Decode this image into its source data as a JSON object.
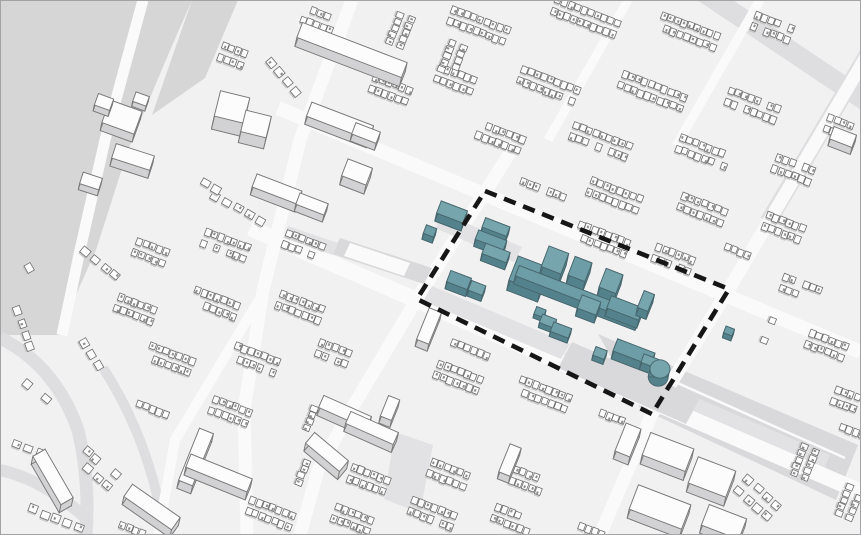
{
  "scene": {
    "width": 861,
    "height": 535,
    "description": "axonometric-3d-city-massing-map-with-highlighted-site",
    "colors": {
      "ground": "#f1f1f2",
      "park": "#d6d6d7",
      "paved": "#d9d9db",
      "paved_light": "#e2e2e4",
      "road_white": "#fafafb",
      "road_gray": "#dedee0",
      "house_top": "#fdfdfd",
      "house_side": "#c9c9c9",
      "house_stroke": "#6e6e6e",
      "house_mark": "#8f8f8f",
      "slab_top": "#fcfcfd",
      "slab_side": "#d2d2d4",
      "slab_stroke": "#7a7a7a",
      "teal_top": "#76a5ad",
      "teal_top_alt": "#6d9da6",
      "teal_side": "#54828c",
      "teal_stroke": "#47666d",
      "boundary": "#161616",
      "frame": "#a3a3a6"
    }
  },
  "areas": [
    {
      "pts": [
        [
          0,
          0
        ],
        [
          192,
          0
        ],
        [
          168,
          55
        ],
        [
          128,
          150
        ],
        [
          96,
          250
        ],
        [
          58,
          335
        ],
        [
          0,
          335
        ]
      ],
      "fill": "park",
      "over": false
    },
    {
      "pts": [
        [
          192,
          0
        ],
        [
          238,
          0
        ],
        [
          205,
          78
        ],
        [
          152,
          115
        ]
      ],
      "fill": "park",
      "over": false
    },
    {
      "pts": [
        [
          598,
          334
        ],
        [
          858,
          445
        ],
        [
          836,
          500
        ],
        [
          640,
          408
        ]
      ],
      "fill": "paved",
      "over": false
    },
    {
      "pts": [
        [
          690,
          395
        ],
        [
          830,
          455
        ],
        [
          818,
          482
        ],
        [
          676,
          420
        ]
      ],
      "fill": "paved_light",
      "over": false
    },
    {
      "pts": [
        [
          432,
          286
        ],
        [
          570,
          344
        ],
        [
          561,
          359
        ],
        [
          423,
          301
        ]
      ],
      "fill": "paved_light",
      "over": true
    },
    {
      "pts": [
        [
          572,
          342
        ],
        [
          700,
          398
        ],
        [
          686,
          424
        ],
        [
          558,
          368
        ]
      ],
      "fill": "paved",
      "over": true
    },
    {
      "pts": [
        [
          443,
          213
        ],
        [
          522,
          247
        ],
        [
          514,
          262
        ],
        [
          435,
          228
        ]
      ],
      "fill": "paved_light",
      "over": true
    },
    {
      "pts": [
        [
          340,
          238
        ],
        [
          432,
          268
        ],
        [
          424,
          284
        ],
        [
          332,
          254
        ]
      ],
      "fill": "paved",
      "over": true
    },
    {
      "pts": [
        [
          350,
          243
        ],
        [
          410,
          263
        ],
        [
          404,
          276
        ],
        [
          344,
          256
        ]
      ],
      "fill": "road_white",
      "over": true
    },
    {
      "pts": [
        [
          288,
          226
        ],
        [
          338,
          243
        ],
        [
          333,
          255
        ],
        [
          283,
          238
        ]
      ],
      "fill": "paved_light",
      "over": true
    },
    {
      "pts": [
        [
          395,
          432
        ],
        [
          433,
          445
        ],
        [
          420,
          513
        ],
        [
          384,
          499
        ]
      ],
      "fill": "paved_light",
      "over": true
    }
  ],
  "roads": [
    {
      "pts": [
        [
          700,
          -10
        ],
        [
          882,
          112
        ]
      ],
      "w": 20,
      "c": "road_gray"
    },
    {
      "pts": [
        [
          876,
          40
        ],
        [
          768,
          222
        ]
      ],
      "w": 17,
      "c": "road_gray"
    },
    {
      "path": "M103,368 Q150,440 165,535",
      "w": 10,
      "c": "road_gray"
    },
    {
      "path": "M0,338 Q55,365 78,430 Q90,480 86,535",
      "w": 13,
      "c": "road_gray"
    },
    {
      "path": "M0,470 Q45,480 88,520",
      "w": 12,
      "c": "road_gray"
    },
    {
      "pts": [
        [
          278,
          108
        ],
        [
          861,
          352
        ]
      ],
      "w": 14,
      "c": "road_white"
    },
    {
      "pts": [
        [
          250,
          228
        ],
        [
          861,
          492
        ]
      ],
      "w": 16,
      "c": "road_white"
    },
    {
      "pts": [
        [
          515,
          145
        ],
        [
          485,
          192
        ],
        [
          417,
          299
        ],
        [
          352,
          408
        ],
        [
          318,
          470
        ],
        [
          300,
          535
        ]
      ],
      "w": 13,
      "c": "road_white"
    },
    {
      "pts": [
        [
          876,
          40
        ],
        [
          729,
          289
        ],
        [
          652,
          414
        ],
        [
          600,
          535
        ]
      ],
      "w": 13,
      "c": "road_white"
    },
    {
      "pts": [
        [
          352,
          0
        ],
        [
          300,
          140
        ],
        [
          263,
          290
        ],
        [
          244,
          410
        ],
        [
          247,
          535
        ]
      ],
      "w": 13,
      "c": "road_white"
    },
    {
      "pts": [
        [
          143,
          0
        ],
        [
          105,
          140
        ],
        [
          80,
          250
        ],
        [
          62,
          335
        ]
      ],
      "w": 11,
      "c": "road_white"
    },
    {
      "pts": [
        [
          628,
          0
        ],
        [
          548,
          140
        ]
      ],
      "w": 9,
      "c": "road_white"
    },
    {
      "pts": [
        [
          760,
          0
        ],
        [
          676,
          146
        ]
      ],
      "w": 9,
      "c": "road_white"
    },
    {
      "pts": [
        [
          262,
          295
        ],
        [
          175,
          440
        ],
        [
          158,
          535
        ]
      ],
      "w": 10,
      "c": "road_white"
    },
    {
      "pts": [
        [
          615,
          355
        ],
        [
          845,
          458
        ]
      ],
      "w": 2.5,
      "c": "road_white"
    }
  ],
  "clusters": [
    [
      478,
      28,
      21,
      2,
      9,
      0
    ],
    [
      585,
      20,
      21,
      2,
      10,
      0
    ],
    [
      688,
      34,
      21,
      2,
      9,
      0
    ],
    [
      772,
      30,
      21,
      2,
      6,
      0
    ],
    [
      455,
      82,
      21,
      2,
      6,
      0
    ],
    [
      548,
      88,
      21,
      2,
      9,
      0
    ],
    [
      652,
      94,
      21,
      2,
      10,
      0
    ],
    [
      752,
      108,
      21,
      2,
      8,
      0
    ],
    [
      838,
      130,
      21,
      2,
      4,
      0
    ],
    [
      500,
      140,
      21,
      2,
      7,
      0
    ],
    [
      600,
      144,
      21,
      2,
      9,
      0
    ],
    [
      703,
      155,
      21,
      2,
      8,
      0
    ],
    [
      793,
      172,
      21,
      2,
      6,
      0
    ],
    [
      543,
      192,
      21,
      1,
      7,
      0
    ],
    [
      614,
      198,
      21,
      2,
      8,
      0
    ],
    [
      702,
      212,
      21,
      2,
      7,
      0
    ],
    [
      783,
      230,
      21,
      2,
      6,
      0
    ],
    [
      602,
      242,
      21,
      2,
      8,
      0
    ],
    [
      673,
      262,
      21,
      2,
      6,
      0
    ],
    [
      737,
      254,
      21,
      1,
      4,
      0
    ],
    [
      800,
      292,
      21,
      2,
      6,
      0
    ],
    [
      826,
      348,
      21,
      2,
      6,
      0
    ],
    [
      766,
      330,
      112,
      1,
      4,
      0
    ],
    [
      845,
      402,
      21,
      2,
      4,
      0
    ],
    [
      318,
      22,
      21,
      2,
      5,
      0
    ],
    [
      398,
      30,
      112,
      2,
      5,
      0
    ],
    [
      450,
      58,
      112,
      2,
      5,
      0
    ],
    [
      390,
      92,
      21,
      2,
      6,
      0
    ],
    [
      232,
      58,
      21,
      2,
      4,
      0
    ],
    [
      283,
      80,
      50,
      1,
      4,
      1
    ],
    [
      238,
      213,
      30,
      1,
      5,
      1
    ],
    [
      206,
      188,
      30,
      1,
      3,
      1
    ],
    [
      150,
      255,
      21,
      2,
      5,
      0
    ],
    [
      225,
      248,
      21,
      2,
      7,
      0
    ],
    [
      303,
      248,
      21,
      2,
      6,
      0
    ],
    [
      100,
      268,
      40,
      1,
      4,
      1
    ],
    [
      135,
      312,
      21,
      2,
      6,
      0
    ],
    [
      215,
      306,
      21,
      2,
      7,
      0
    ],
    [
      300,
      310,
      21,
      2,
      7,
      0
    ],
    [
      90,
      357,
      60,
      1,
      3,
      1
    ],
    [
      170,
      362,
      21,
      2,
      7,
      0
    ],
    [
      255,
      362,
      21,
      2,
      7,
      0
    ],
    [
      333,
      356,
      21,
      2,
      5,
      0
    ],
    [
      152,
      412,
      21,
      1,
      5,
      0
    ],
    [
      230,
      414,
      21,
      2,
      6,
      0
    ],
    [
      308,
      418,
      112,
      1,
      4,
      0
    ],
    [
      28,
      272,
      60,
      1,
      3,
      1
    ],
    [
      22,
      332,
      70,
      1,
      4,
      1
    ],
    [
      36,
      396,
      40,
      1,
      3,
      1
    ],
    [
      30,
      452,
      21,
      1,
      3,
      1
    ],
    [
      97,
      472,
      40,
      2,
      4,
      1
    ],
    [
      57,
      522,
      21,
      1,
      5,
      1
    ],
    [
      132,
      532,
      21,
      1,
      4,
      0
    ],
    [
      470,
      352,
      21,
      1,
      6,
      0
    ],
    [
      458,
      380,
      21,
      2,
      7,
      0
    ],
    [
      543,
      397,
      21,
      2,
      8,
      0
    ],
    [
      612,
      420,
      21,
      1,
      4,
      0
    ],
    [
      270,
      516,
      21,
      2,
      7,
      0
    ],
    [
      352,
      522,
      21,
      2,
      6,
      0
    ],
    [
      432,
      516,
      21,
      2,
      7,
      0
    ],
    [
      512,
      522,
      21,
      2,
      6,
      0
    ],
    [
      588,
      532,
      21,
      1,
      5,
      0
    ],
    [
      368,
      482,
      21,
      2,
      6,
      0
    ],
    [
      448,
      477,
      21,
      2,
      6,
      0
    ],
    [
      527,
      483,
      21,
      2,
      5,
      0
    ],
    [
      300,
      472,
      112,
      1,
      4,
      0
    ],
    [
      757,
      502,
      40,
      2,
      4,
      1
    ],
    [
      802,
      462,
      112,
      2,
      5,
      0
    ],
    [
      847,
      502,
      112,
      2,
      5,
      0
    ],
    [
      722,
      536,
      21,
      1,
      4,
      0
    ],
    [
      852,
      434,
      21,
      1,
      4,
      0
    ]
  ],
  "slabs": [
    [
      352,
      50,
      21,
      112,
      16,
      9
    ],
    [
      340,
      121,
      21,
      66,
      15,
      8
    ],
    [
      366,
      133,
      21,
      26,
      12,
      7
    ],
    [
      277,
      189,
      21,
      48,
      14,
      8
    ],
    [
      312,
      204,
      21,
      30,
      12,
      7
    ],
    [
      357,
      172,
      21,
      26,
      18,
      9
    ],
    [
      232,
      107,
      14,
      30,
      26,
      13
    ],
    [
      256,
      124,
      14,
      26,
      22,
      11
    ],
    [
      133,
      157,
      18,
      40,
      15,
      8
    ],
    [
      91,
      181,
      18,
      20,
      12,
      6
    ],
    [
      122,
      117,
      20,
      34,
      24,
      8
    ],
    [
      104,
      102,
      20,
      16,
      12,
      6
    ],
    [
      141,
      99,
      20,
      14,
      10,
      5
    ],
    [
      429,
      326,
      112,
      34,
      13,
      7
    ],
    [
      345,
      412,
      24,
      52,
      13,
      8
    ],
    [
      372,
      428,
      24,
      52,
      13,
      8
    ],
    [
      327,
      452,
      40,
      44,
      14,
      8
    ],
    [
      390,
      408,
      112,
      22,
      12,
      7
    ],
    [
      196,
      457,
      112,
      56,
      15,
      8
    ],
    [
      219,
      473,
      22,
      66,
      14,
      8
    ],
    [
      53,
      477,
      60,
      56,
      14,
      8
    ],
    [
      152,
      507,
      35,
      58,
      15,
      8
    ],
    [
      668,
      452,
      21,
      46,
      24,
      9
    ],
    [
      712,
      477,
      21,
      40,
      28,
      9
    ],
    [
      660,
      507,
      21,
      56,
      26,
      9
    ],
    [
      724,
      522,
      21,
      40,
      22,
      8
    ],
    [
      628,
      440,
      112,
      30,
      16,
      8
    ],
    [
      843,
      137,
      21,
      24,
      13,
      7
    ],
    [
      510,
      460,
      112,
      30,
      12,
      7
    ]
  ],
  "site": {
    "prisms": [
      [
        452,
        212,
        21,
        28,
        13,
        8
      ],
      [
        430,
        231,
        21,
        11,
        9,
        6
      ],
      [
        496,
        227,
        21,
        26,
        10,
        7
      ],
      [
        491,
        240,
        21,
        30,
        10,
        7
      ],
      [
        496,
        253,
        21,
        26,
        11,
        7
      ],
      [
        459,
        280,
        21,
        22,
        12,
        7
      ],
      [
        477,
        288,
        21,
        15,
        10,
        6
      ],
      [
        529,
        274,
        21,
        33,
        26,
        10
      ],
      [
        555,
        260,
        21,
        21,
        22,
        12
      ],
      [
        580,
        269,
        21,
        18,
        20,
        10
      ],
      [
        611,
        281,
        21,
        18,
        20,
        10
      ],
      [
        578,
        294,
        21,
        130,
        11,
        8
      ],
      [
        589,
        305,
        21,
        20,
        14,
        8
      ],
      [
        625,
        308,
        21,
        34,
        13,
        8
      ],
      [
        646,
        301,
        112,
        18,
        11,
        8
      ],
      [
        540,
        312,
        21,
        10,
        8,
        4
      ],
      [
        548,
        321,
        21,
        15,
        9,
        5
      ],
      [
        561,
        330,
        21,
        19,
        10,
        5
      ],
      [
        600,
        353,
        21,
        12,
        9,
        5
      ],
      [
        634,
        352,
        21,
        40,
        13,
        8
      ],
      [
        650,
        361,
        21,
        16,
        9,
        7
      ],
      [
        729,
        331,
        21,
        9,
        7,
        5
      ]
    ],
    "cylinders": [
      [
        660,
        369,
        10,
        8
      ]
    ]
  },
  "boundary": {
    "points": [
      [
        485,
        191
      ],
      [
        729,
        289
      ],
      [
        652,
        414
      ],
      [
        417,
        299
      ]
    ],
    "stroke_width": 4.6,
    "dash": [
      12.5,
      8
    ]
  }
}
